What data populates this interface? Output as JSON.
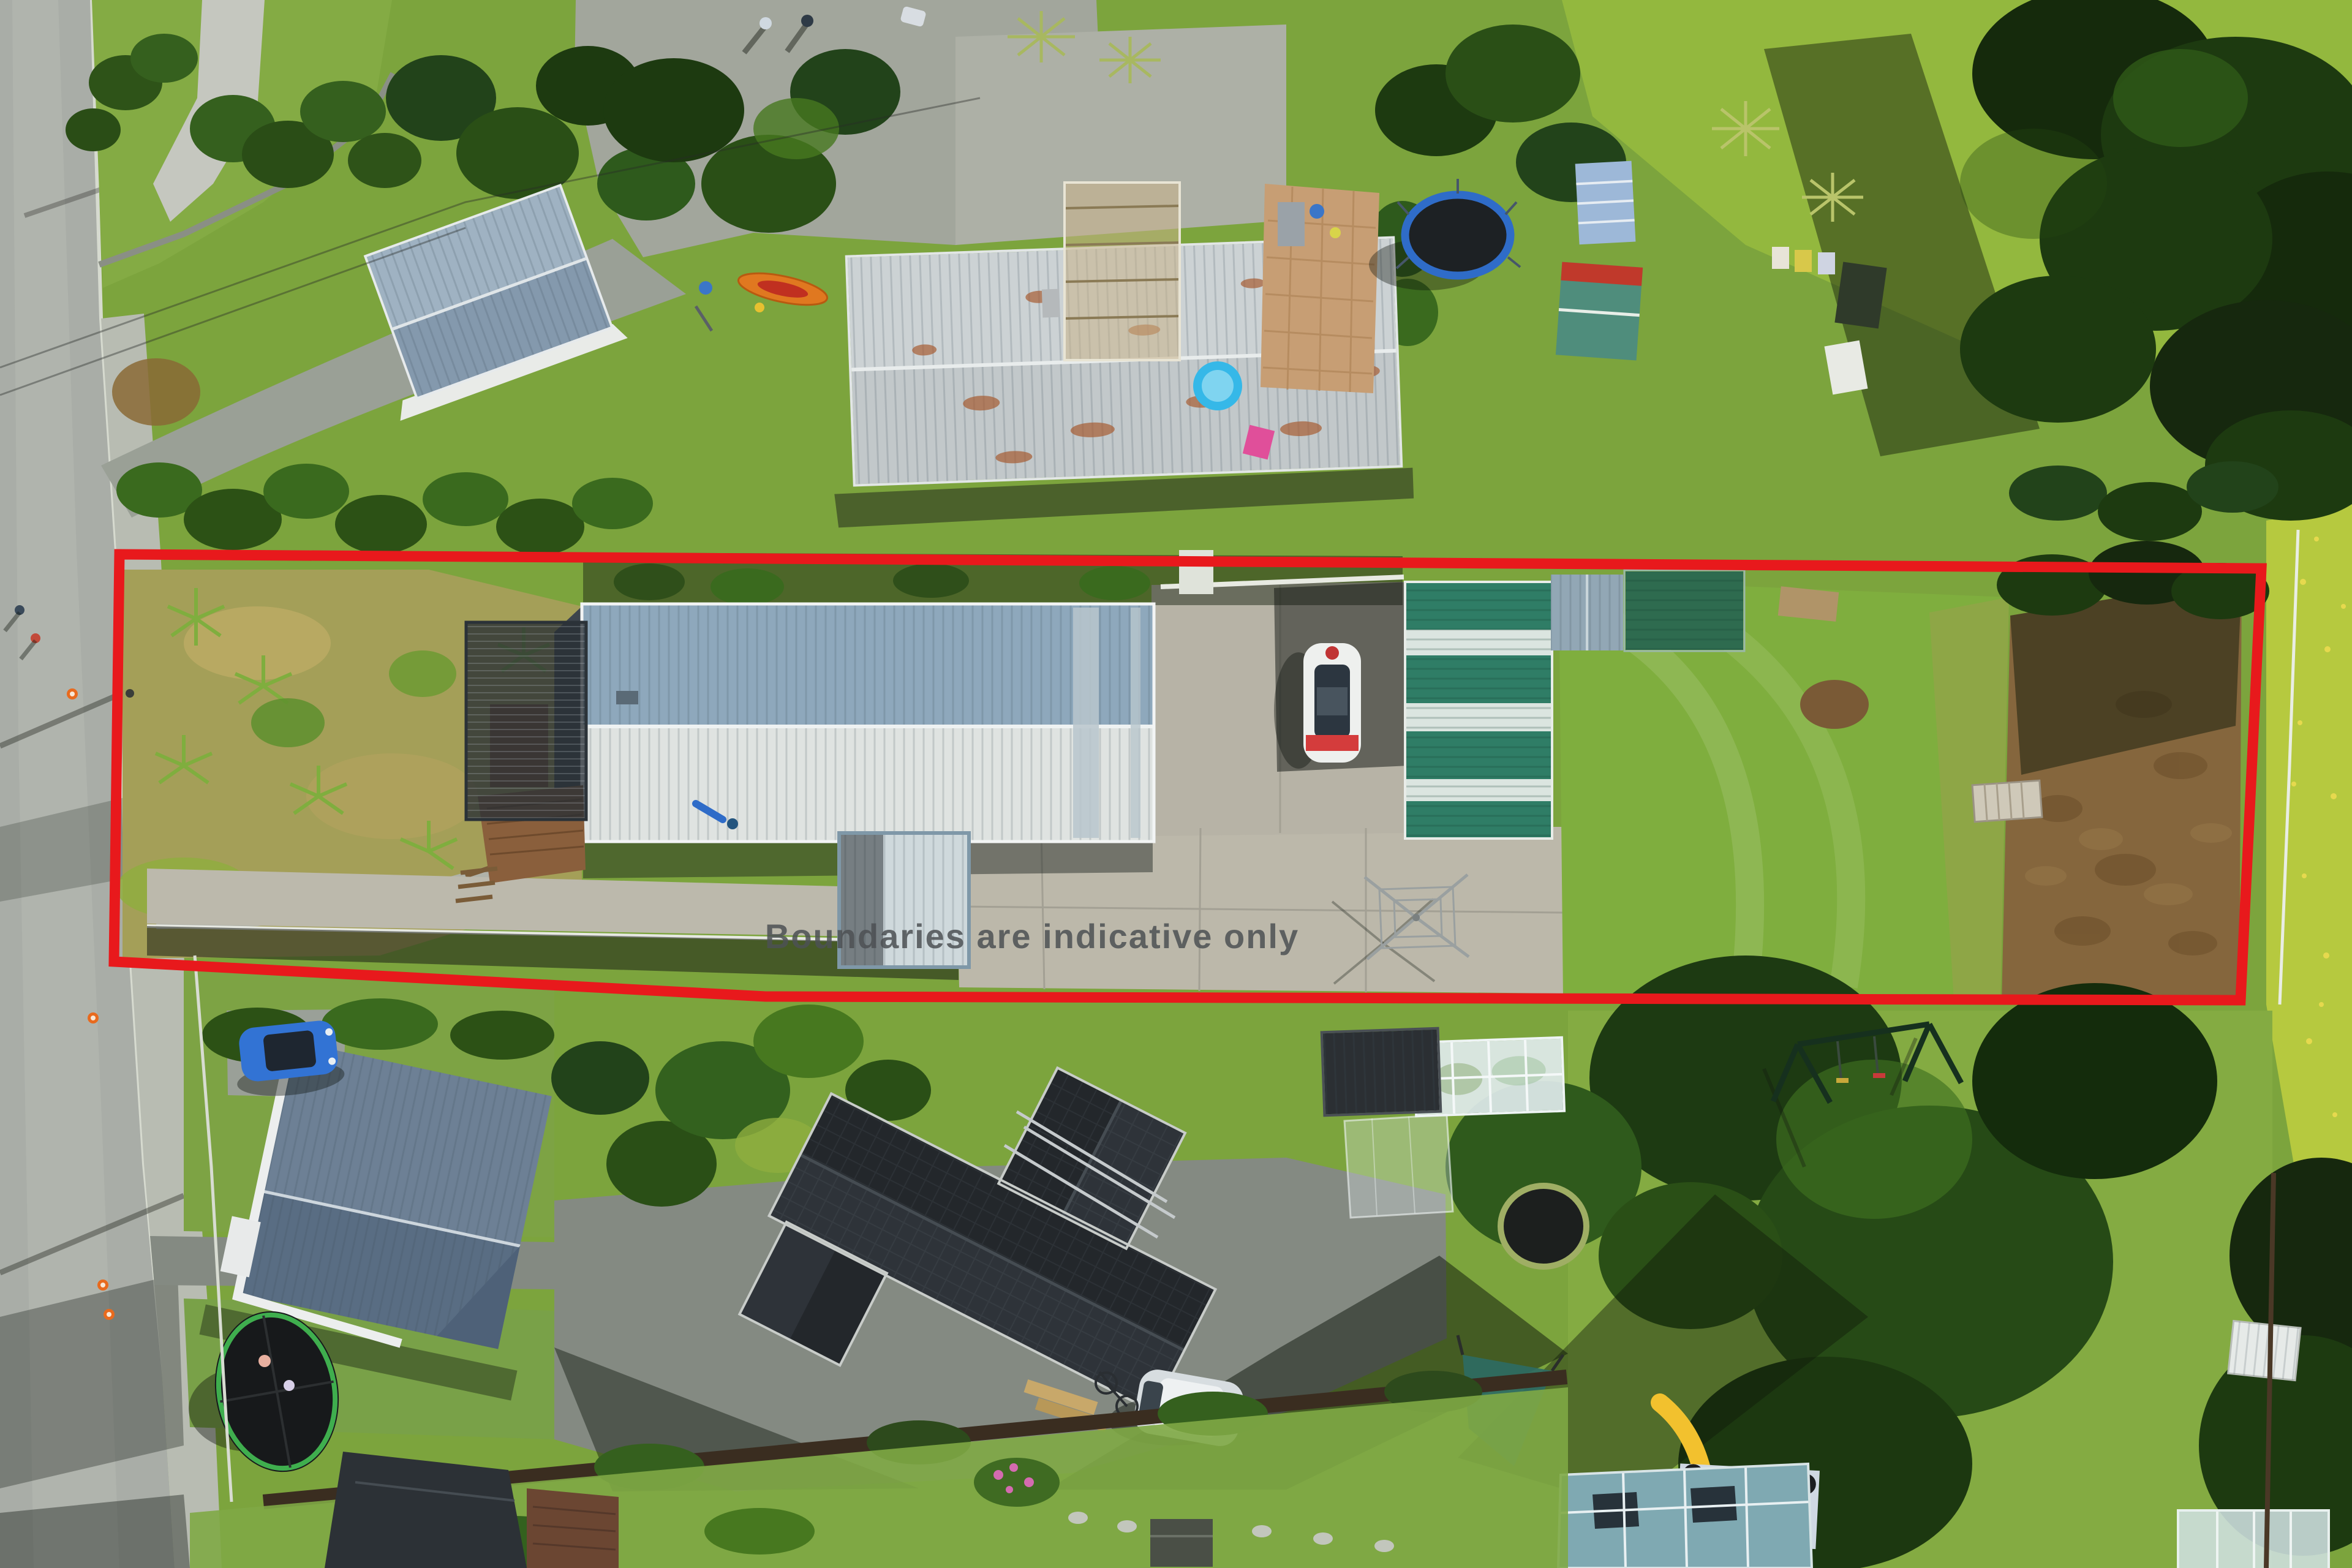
{
  "overlay": {
    "disclaimer_text": "Boundaries are indicative only",
    "disclaimer_color": "#4d5154",
    "boundary_points": "195,905 3692,928 3658,1633 1250,1627 186,1570",
    "boundary_color": "#e8191c",
    "boundary_stroke_width": 17
  },
  "scene": {
    "type": "aerial-drone-photo",
    "description": "Top-down aerial photo of a long rectangular residential section outlined in red, main shed-style house with two-tone roof, green striped garage, concrete pad, lawn and dry paddock, surrounded by neighbouring houses, road on the left and gardens below",
    "palette": {
      "grass_base": "#7ca43d",
      "grass_bright": "#8fb848",
      "meadow_right": "#b6c93f",
      "tree_dark": "#16280e",
      "road_asphalt": "#a9ada7",
      "footpath": "#b8bcb2",
      "gravel": "#a2a69c",
      "concrete_pad": "#bcb8aa",
      "patio_tan": "#c79e74",
      "paddock_dirt": "#85663d",
      "main_roof_upper": "#8ea8bc",
      "main_roof_lower": "#dfe3e1",
      "garage_green": "#2f7d66",
      "black_roof_house": "#23272b",
      "boundary_red": "#e8191c"
    },
    "objects": [
      {
        "name": "red-boundary-outline",
        "color": "#e8191c"
      },
      {
        "name": "boundary-disclaimer-text",
        "color": "#4d5154"
      },
      {
        "name": "main-house-roof",
        "colors": [
          "#8ea8bc",
          "#dfe3e1"
        ]
      },
      {
        "name": "lean-to-extension-roof",
        "color": "#cfd9dc"
      },
      {
        "name": "deck-pergola",
        "color": "#3a4148"
      },
      {
        "name": "green-striped-garage",
        "colors": [
          "#2f7d66",
          "#e7ece8"
        ]
      },
      {
        "name": "gray-garden-shed",
        "color": "#92a7b5"
      },
      {
        "name": "green-flat-shed",
        "color": "#2e6b4f"
      },
      {
        "name": "white-car-on-concrete",
        "colors": [
          "#eef0ee",
          "#d43c3c"
        ]
      },
      {
        "name": "concrete-pad",
        "color": "#bcb8aa"
      },
      {
        "name": "rotary-clothesline",
        "color": "#9aa0a0"
      },
      {
        "name": "property-lawn",
        "color": "#7fae3e"
      },
      {
        "name": "dry-paddock",
        "color": "#85663d"
      },
      {
        "name": "wooden-platform",
        "color": "#cfc9b9"
      },
      {
        "name": "top-left-neighbour-house",
        "color": "#93a7b8"
      },
      {
        "name": "long-neighbour-house",
        "colors": [
          "#c9cfd2",
          "#a65c33"
        ]
      },
      {
        "name": "paved-patio",
        "color": "#c79e74"
      },
      {
        "name": "kiddie-pool",
        "color": "#35b8e8"
      },
      {
        "name": "trampoline-top",
        "colors": [
          "#1d2124",
          "#2f6cc8"
        ]
      },
      {
        "name": "orange-kayak",
        "color": "#e07820"
      },
      {
        "name": "black-roof-house",
        "color": "#23272b"
      },
      {
        "name": "silver-car",
        "color": "#d7dde0"
      },
      {
        "name": "blue-car",
        "color": "#3273d4"
      },
      {
        "name": "glass-greenhouse",
        "color": "#dfeaec"
      },
      {
        "name": "swing-set",
        "color": "#16301e"
      },
      {
        "name": "yellow-slide",
        "color": "#f2c12e"
      },
      {
        "name": "teal-roof-shed",
        "color": "#7fa9b2"
      },
      {
        "name": "trampoline-bottom-left",
        "colors": [
          "#17191b",
          "#3fae4e"
        ]
      },
      {
        "name": "road",
        "color": "#a9ada7"
      },
      {
        "name": "traffic-cones",
        "color": "#e86a1e"
      }
    ]
  }
}
